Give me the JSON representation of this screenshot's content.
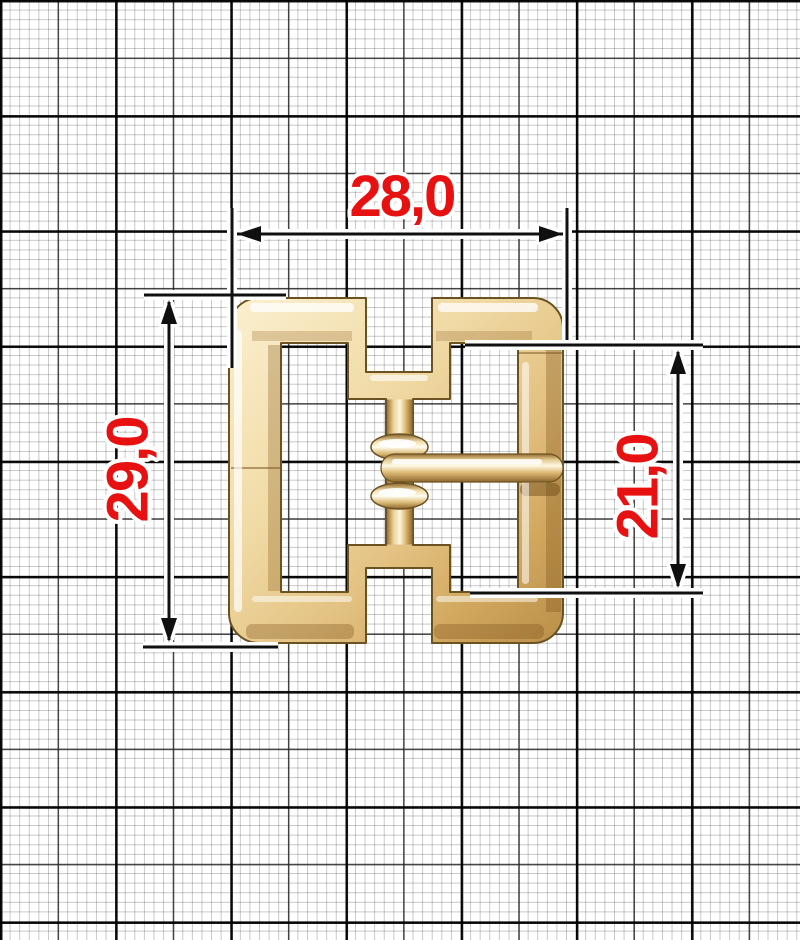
{
  "diagram": {
    "type": "technical-dimension-drawing",
    "subject": "gold metal buckle with center post and pin",
    "background_style": "graph paper grid",
    "dimensions": [
      {
        "id": "width",
        "label": "28,0",
        "value_mm": 28.0,
        "orientation": "horizontal",
        "position": "top"
      },
      {
        "id": "height",
        "label": "29,0",
        "value_mm": 29.0,
        "orientation": "vertical",
        "position": "left"
      },
      {
        "id": "inner_height",
        "label": "21,0",
        "value_mm": 21.0,
        "orientation": "vertical",
        "position": "right"
      }
    ],
    "colors": {
      "dimension_text": "#e81111",
      "dimension_lines": "#101010",
      "halo": "#ffffff",
      "grid_fine": "#c9c9c9",
      "grid_medium": "#2e2e2e",
      "grid_bold": "#000000",
      "paper": "#ffffff",
      "gold_highlight": "#fbf0d0",
      "gold_light": "#f1dca8",
      "gold_mid": "#e4c485",
      "gold_deep": "#b98f49",
      "gold_outline": "#6b5222"
    }
  }
}
